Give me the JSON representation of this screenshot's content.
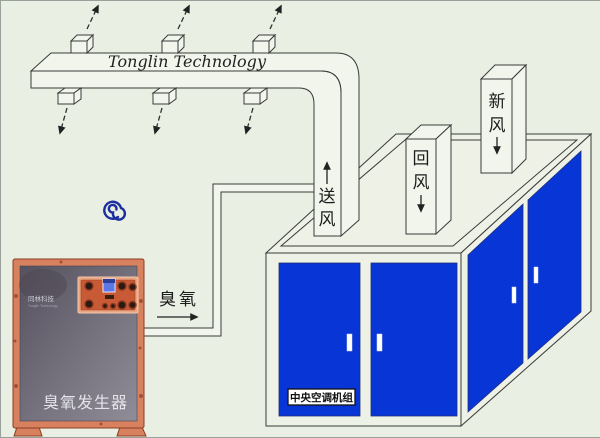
{
  "colors": {
    "background": "#e9efe2",
    "surface": "#f2f5ec",
    "line": "#3a3a3a",
    "door_blue": "#0836d6",
    "frame_orange": "#d8815f",
    "panel_gradient_from": "#56515e",
    "panel_gradient_to": "#908d99",
    "control_orange": "#c85a36",
    "logo_blue": "#1b2f9e"
  },
  "duct": {
    "brand_text": "Tonglin Technology"
  },
  "labels": {
    "supply_air": "送风",
    "return_air": "回风",
    "fresh_air": "新风",
    "ozone": "臭氧"
  },
  "generator": {
    "brand": "同林科技",
    "brand_sub": "Tonglin Technology",
    "name_label": "臭氧发生器"
  },
  "ac_unit": {
    "name_label": "中央空调机组"
  }
}
